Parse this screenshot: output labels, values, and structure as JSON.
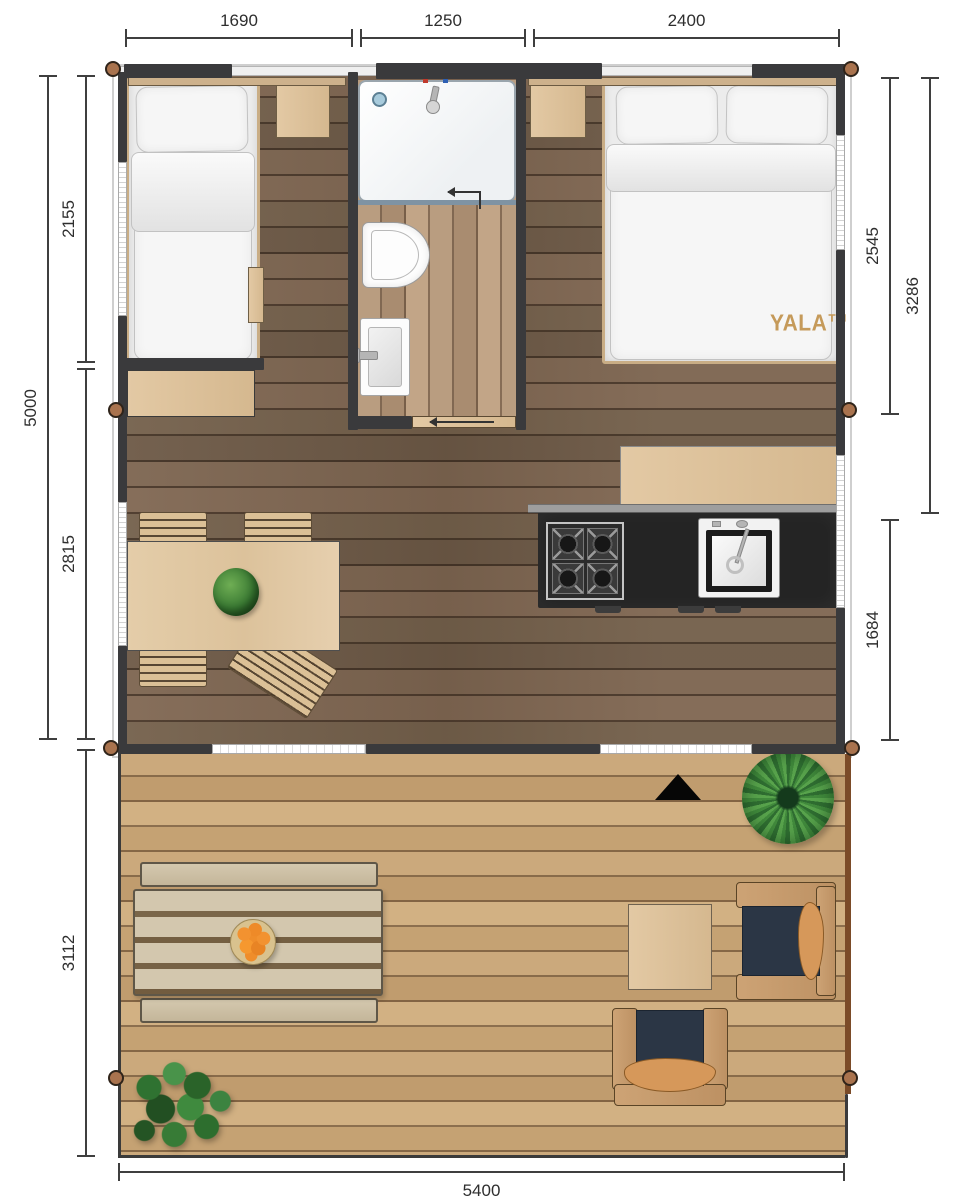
{
  "brand": {
    "logo": "YALA™"
  },
  "dimensions": {
    "top": {
      "bedroom_width": "1690",
      "bathroom_width": "1250",
      "master_width": "2400"
    },
    "left": {
      "tent_depth": "5000",
      "sleeping_depth": "2155",
      "living_depth": "2815",
      "deck_depth": "3112"
    },
    "right": {
      "master_zone": "2545",
      "front_zone": "3286",
      "kitchen_zone": "1684"
    },
    "bottom": {
      "total_width": "5400"
    }
  },
  "colors": {
    "wall-charcoal": "#3a3a3c",
    "floor-interior": "#7a6350",
    "floor-bathroom": "#b59a7d",
    "floor-deck": "#c9a678",
    "wood-furniture": "#ddc19c",
    "counter-dark": "#242424",
    "cushion-navy": "#2b3645",
    "pillow-orange": "#d6985a",
    "plant-green": "#47903f",
    "fruit-orange": "#ee8e2e",
    "pole-brown": "#a9734e",
    "dim-line": "#3f3f3f",
    "yala-gold": "#c59a5a",
    "bedding-white": "#f6f6f6",
    "window-white": "#f2f2f2"
  }
}
